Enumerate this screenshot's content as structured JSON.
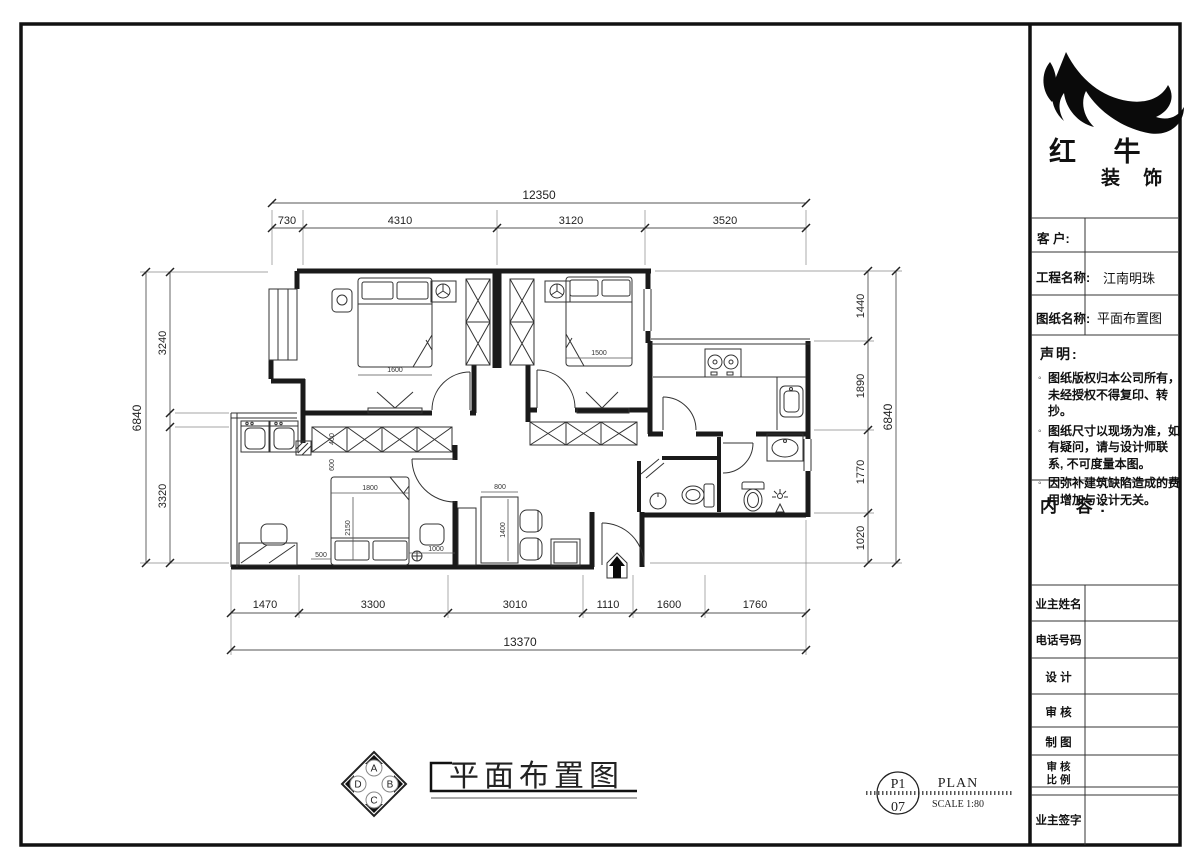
{
  "title_block": {
    "brand_line1": "红 牛",
    "brand_line2": "装 饰",
    "rows": [
      {
        "label": "客  户:",
        "value": ""
      },
      {
        "label": "工程名称:",
        "value": "江南明珠"
      },
      {
        "label": "图纸名称:",
        "value": "平面布置图"
      }
    ],
    "statement": {
      "heading": "声明:",
      "bullet_marker": "◦",
      "items": [
        "图纸版权归本公司所有，未经授权不得复印、转抄。",
        "图纸尺寸以现场为准，如有疑问，请与设计师联系, 不可度量本图。",
        "因弥补建筑缺陷造成的费用增加与设计无关。"
      ]
    },
    "content_label": "内 容:",
    "signature_rows": {
      "owner_name": "业主姓名",
      "phone": "电话号码",
      "design": "设 计",
      "review": "审 核",
      "draft": "制 图",
      "review2": "审 核",
      "scale": "比 例",
      "owner_sign": "业主签字"
    }
  },
  "dims": {
    "top_total": "12350",
    "top_segs": [
      "730",
      "4310",
      "3120",
      "3520"
    ],
    "bottom_total": "13370",
    "bottom_segs": [
      "1470",
      "3300",
      "3010",
      "1110",
      "1600",
      "1760"
    ],
    "left_total": "6840",
    "left_segs": [
      "3240",
      "3320"
    ],
    "right_total": "6840",
    "right_segs": [
      "1440",
      "1890",
      "1770",
      "1020"
    ]
  },
  "plan_dims": {
    "master_bed_w": "1600",
    "bed2_w": "1500",
    "bed3_w": "1800",
    "bed3_l": "2150",
    "wardrobe_d": "400",
    "clearance": "600",
    "side_left": "500",
    "side_right": "1000",
    "table_w": "800",
    "table_l": "1400"
  },
  "footer": {
    "plan_title": "平面布置图",
    "sheet_top": "P1",
    "sheet_bottom": "07",
    "sheet_label": "PLAN",
    "scale_label": "SCALE 1:80",
    "compass": {
      "n": "A",
      "e": "B",
      "s": "C",
      "w": "D"
    }
  },
  "colors": {
    "ink": "#1a1a1a",
    "dim_line": "#555",
    "paper": "#ffffff"
  }
}
